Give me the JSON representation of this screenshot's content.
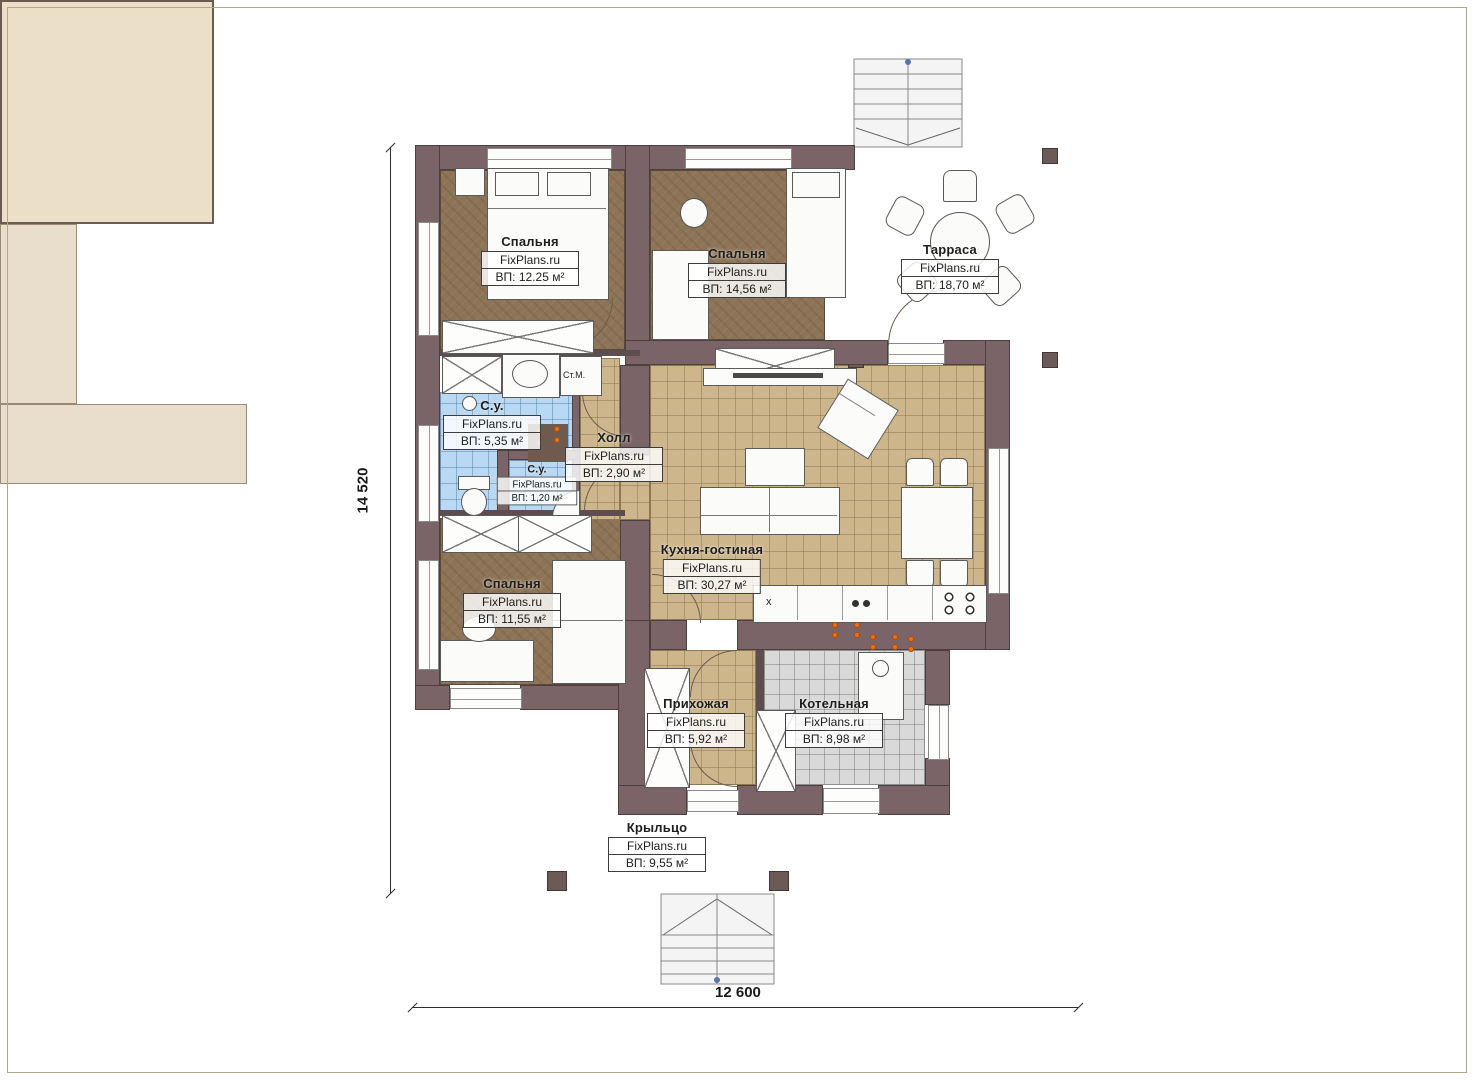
{
  "plan": {
    "dim_height": "14 520",
    "dim_width": "12 600",
    "washing_machine_label": "Ст.М.",
    "counter_mark": "x"
  },
  "rooms": [
    {
      "key": "bedroom-1",
      "name": "Спальня",
      "brand": "FixPlans.ru",
      "area": "ВП: 12.25 м²"
    },
    {
      "key": "bedroom-2",
      "name": "Спальня",
      "brand": "FixPlans.ru",
      "area": "ВП: 14,56 м²"
    },
    {
      "key": "terrace",
      "name": "Тарраса",
      "brand": "FixPlans.ru",
      "area": "ВП: 18,70 м²"
    },
    {
      "key": "bathroom-1",
      "name": "С.у.",
      "brand": "FixPlans.ru",
      "area": "ВП: 5,35 м²"
    },
    {
      "key": "bathroom-2",
      "name": "С.у.",
      "brand": "FixPlans.ru",
      "area": "ВП: 1,20 м²"
    },
    {
      "key": "hall",
      "name": "Холл",
      "brand": "FixPlans.ru",
      "area": "ВП: 2,90 м²"
    },
    {
      "key": "kitchen-living",
      "name": "Кухня-гостиная",
      "brand": "FixPlans.ru",
      "area": "ВП: 30,27 м²"
    },
    {
      "key": "bedroom-3",
      "name": "Спальня",
      "brand": "FixPlans.ru",
      "area": "ВП: 11,55 м²"
    },
    {
      "key": "entry",
      "name": "Прихожая",
      "brand": "FixPlans.ru",
      "area": "ВП: 5,92 м²"
    },
    {
      "key": "boiler",
      "name": "Котельная",
      "brand": "FixPlans.ru",
      "area": "ВП: 8,98 м²"
    },
    {
      "key": "porch",
      "name": "Крыльцо",
      "brand": "FixPlans.ru",
      "area": "ВП: 9,55 м²"
    }
  ],
  "colors": {
    "wall": "#7b6467",
    "bedroom_floor": "#8d7456",
    "tan_floor": "#cdb68c",
    "bath_floor": "#b9d9f2",
    "boiler_floor": "#d9d9d9",
    "terrace_floor": "#ecdfc8",
    "porch_floor": "#e9decb",
    "accent_orange": "#e8701a"
  }
}
